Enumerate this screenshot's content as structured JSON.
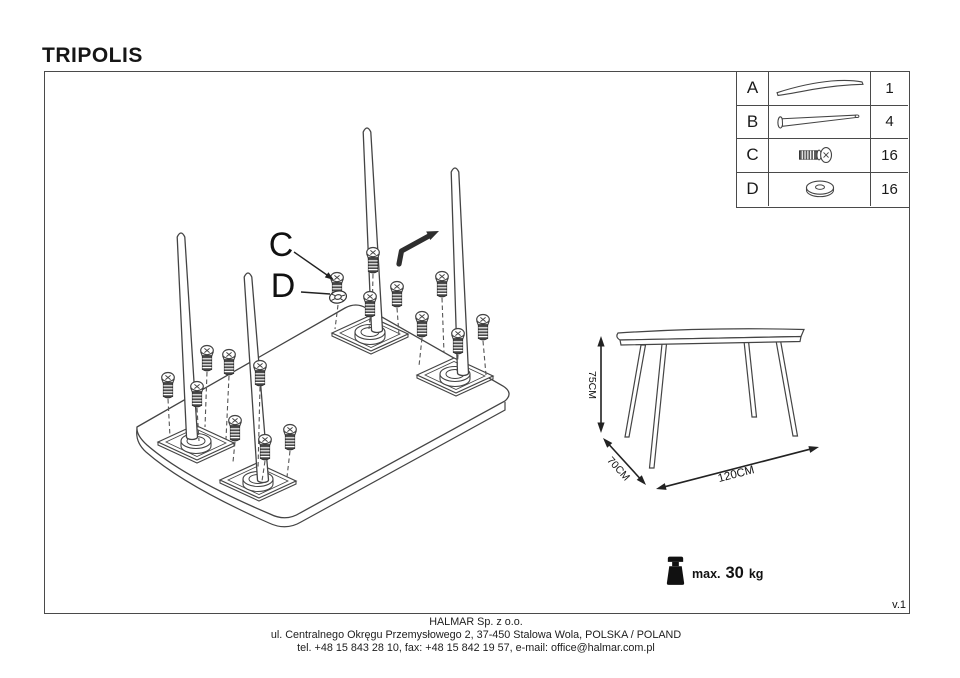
{
  "title": "TRIPOLIS",
  "version": "v.1",
  "parts_table": {
    "rows": [
      {
        "letter": "A",
        "icon": "tabletop-panel-icon",
        "quantity": "1"
      },
      {
        "letter": "B",
        "icon": "table-leg-icon",
        "quantity": "4"
      },
      {
        "letter": "C",
        "icon": "screw-icon",
        "quantity": "16"
      },
      {
        "letter": "D",
        "icon": "washer-icon",
        "quantity": "16"
      }
    ]
  },
  "exploded_view": {
    "callout_c": "C",
    "callout_d": "D"
  },
  "dimension_drawing": {
    "height_label": "75CM",
    "depth_label": "70CM",
    "width_label": "120CM"
  },
  "weight_limit": {
    "prefix": "max.",
    "value": "30",
    "unit": "kg"
  },
  "footer": {
    "company": "HALMAR Sp. z o.o.",
    "address": "ul. Centralnego Okręgu Przemysłowego 2, 37-450 Stalowa Wola, POLSKA / POLAND",
    "contact": "tel. +48 15 843 28 10, fax: +48 15 842 19 57, e-mail: office@halmar.com.pl"
  },
  "colors": {
    "line": "#444444",
    "text": "#111111",
    "background": "#ffffff"
  }
}
